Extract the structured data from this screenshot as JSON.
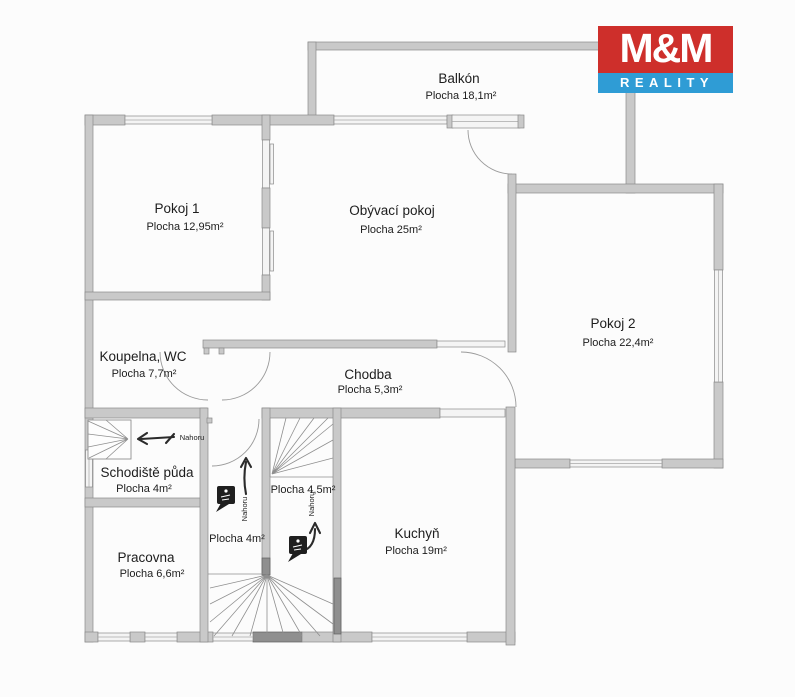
{
  "logo": {
    "top": "M&M",
    "bottom": "REALITY"
  },
  "colors": {
    "logo-red": "#ce2f2b",
    "logo-blue": "#2f9cd5",
    "wall-fill": "#c9c9c9",
    "line": "#8a8a8a",
    "ink": "#1d1d1d"
  },
  "rooms": {
    "balkon": {
      "name": "Balkón",
      "area": "Plocha 18,1m²"
    },
    "pokoj1": {
      "name": "Pokoj 1",
      "area": "Plocha 12,95m²"
    },
    "obyvaci": {
      "name": "Obývací pokoj",
      "area": "Plocha 25m²"
    },
    "pokoj2": {
      "name": "Pokoj 2",
      "area": "Plocha 22,4m²"
    },
    "koupelna": {
      "name": "Koupelna, WC",
      "area": "Plocha 7,7m²"
    },
    "chodba": {
      "name": "Chodba",
      "area": "Plocha 5,3m²"
    },
    "schodiste": {
      "name": "Schodiště půda",
      "area": "Plocha 4m²"
    },
    "pracovna": {
      "name": "Pracovna",
      "area": "Plocha 6,6m²"
    },
    "kuchyn": {
      "name": "Kuchyň",
      "area": "Plocha 19m²"
    },
    "stair_mid": {
      "area": "Plocha 4,5m²"
    },
    "stair_lobby": {
      "area": "Plocha 4m²"
    }
  },
  "annotations": {
    "nahoru": "Nahoru"
  }
}
